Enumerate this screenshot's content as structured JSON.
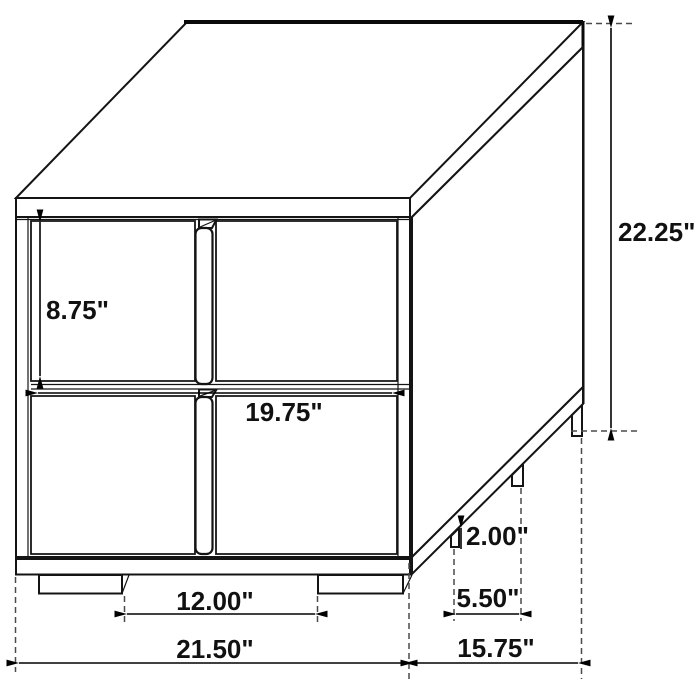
{
  "diagram": {
    "subject": "two-drawer nightstand dimension drawing",
    "unit": "inches",
    "colors": {
      "line": "#141414",
      "dimension_line": "#000000",
      "extension_line": "#4a4a4a",
      "background": "#ffffff"
    },
    "labels": {
      "overall_height": "22.25\"",
      "drawer_front_height": "8.75\"",
      "drawer_front_width": "19.75\"",
      "leg_height": "2.00\"",
      "side_leg_spacing": "5.50\"",
      "front_leg_spacing": "12.00\"",
      "overall_width": "21.50\"",
      "overall_depth": "15.75\""
    }
  }
}
